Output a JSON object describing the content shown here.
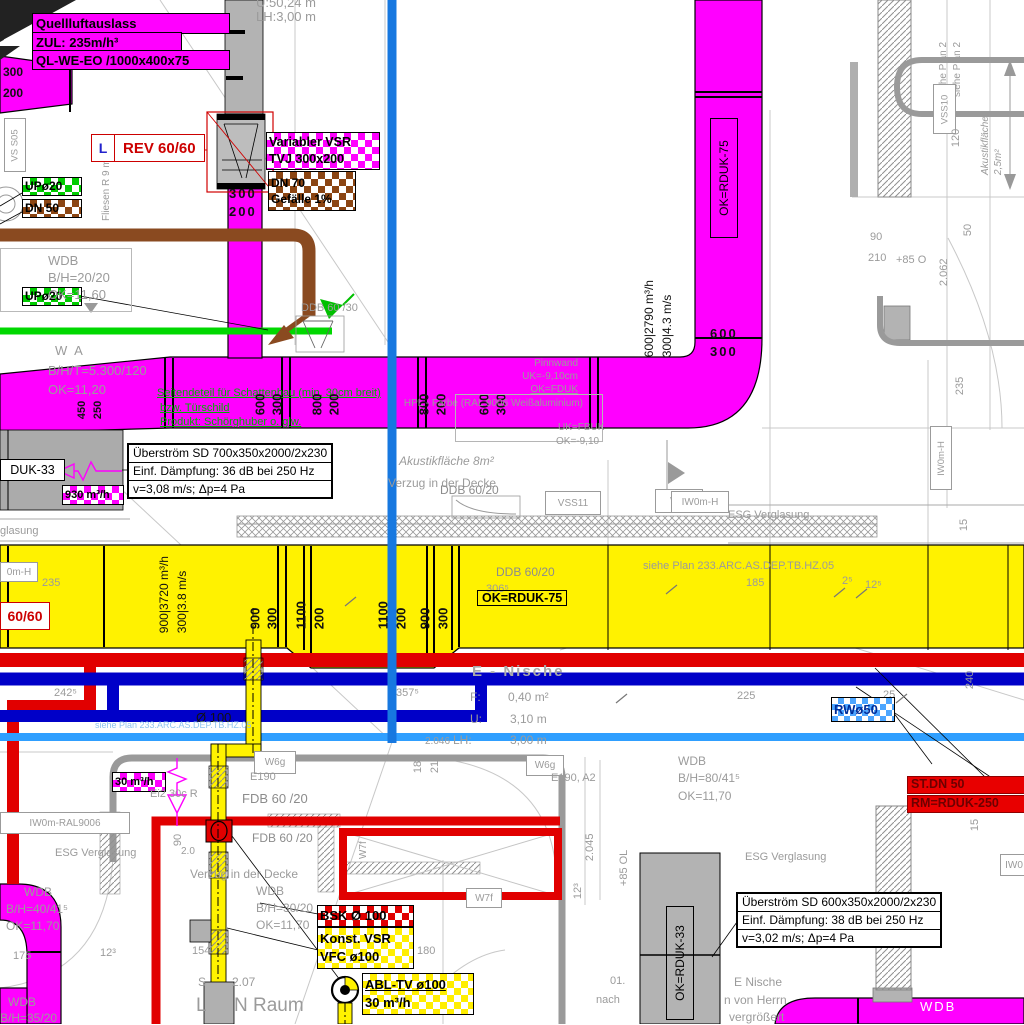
{
  "colors": {
    "duct_supply": "#ff00ff",
    "duct_return": "#fff200",
    "pipe_hot": "#e10000",
    "pipe_cold": "#0000c8",
    "pipe_cw": "#2f9fff",
    "pipe_green": "#00d800",
    "pipe_brown": "#8a4a20",
    "section_line": "#1778e0"
  },
  "dims": {
    "d600": "600",
    "d300": "300",
    "d800": "800",
    "d200": "200",
    "d900": "900",
    "d1100": "1100",
    "flow2790": "600|2790 m³/h",
    "speed43": "300|4.3 m/s",
    "flow3720": "900|3720 m³/h",
    "speed38": "300|3.8 m/s",
    "d450": "450",
    "d250": "250",
    "d235": "235",
    "d185": "185",
    "d2_5": "2⁵",
    "d12_5": "12⁵",
    "d12_3": "12³",
    "d242": "242⁵",
    "d357": "357⁵",
    "d306": "306⁵",
    "d225": "225",
    "d25": "25",
    "d240": "240",
    "d2046": "2.046",
    "d2045": "2.045",
    "d2062": "2.062",
    "d180": "180",
    "d210": "210",
    "d120": "120",
    "d90": "90",
    "d50": "50",
    "d15": "15",
    "d175": "175",
    "d154": "154",
    "plus85o": "+85 O",
    "plus85ol": "+85 OL",
    "d2_0": "2.0"
  },
  "top_left": {
    "outlet1": "Quellluftauslass",
    "outlet2": "ZUL: 235m/h³",
    "outlet3": "QL-WE-EO /1000x400x75",
    "vs_s05": "VS S05",
    "fliesen": "Fliesen R 9 m²",
    "up20": "UPø20",
    "dn50": "DN 50",
    "rev_l": "L",
    "rev": "REV 60/60",
    "vsr1": "Variabler VSR",
    "vsr2": "TVJ 300x200",
    "dn70": "DN 70",
    "gefaelle": "Gefälle 1%",
    "u_dim": "U:50,24 m",
    "lh_dim": "LH:3,00 m",
    "ddb30": "DDB 60 /30"
  },
  "stamps": {
    "wdb": "WDB",
    "bh2020": "B/H=20/20",
    "ok1160": "OK=11,60",
    "wa": "W A",
    "bht": "B/H/T=5.300/120",
    "ok1120": "OK=11,20",
    "bh8041": "B/H=80/41⁵",
    "ok1170": "OK=11,70",
    "bh4041": "B/H=40/41⁵",
    "bh3020": "B/H=30/20",
    "bh3520": "B/H=35/20"
  },
  "door_note": {
    "l1": "Seitendeteil für Schattenbau (min. 30cm breit)",
    "l2": "bzw. Türschild",
    "l3": "Produkt: Schörghuber o. glw."
  },
  "pinnwand": {
    "l1": "Pinnwand",
    "l2": "UK=-9,10cm",
    "l3": "OK=FDUK",
    "l4": "HPL - Farbe (RAL 9006 Weißaluminium)",
    "l5": "UK=FBUK",
    "l6": "OK=-9,10"
  },
  "ueberstrom1": {
    "l1": "Überström SD 700x350x2000/2x230",
    "l2": "Einf. Dämpfung: 36 dB bei 250 Hz",
    "l3": "v=3,08 m/s; Δp=4 Pa"
  },
  "ueberstrom2": {
    "l1": "Überström SD 600x350x2000/2x230",
    "l2": "Einf. Dämpfung: 38 dB bei 250 Hz",
    "l3": "v=3,02 m/s; Δp=4 Pa"
  },
  "tags": {
    "duk33": "DUK-33",
    "flow930": "930 m³/h",
    "flow30": "30 m³/h",
    "rduk75": "OK=RDUK-75",
    "rduk33": "OK=RDUK-33",
    "rw50": "RWø50",
    "bsk": "BSK Ø 100",
    "konst1": "Konst. VSR",
    "konst2": "VFC ø100",
    "abl1": "ABL-TV ø100",
    "stdn": "ST.DN 50",
    "rm250": "RM=RDUK-250",
    "rev6060": "60/60",
    "ddb6020": "DDB 60/20",
    "fdb6020": "FDB 60 /20",
    "ei2": "Ei2 30c R"
  },
  "boxes": {
    "w6g": "W6g",
    "w6f": "W6f",
    "w7f": "W7f",
    "vss10": "VSS10",
    "vss11": "VSS11",
    "iw0mh": "IW0m-H",
    "iw0mh_cut": "0m-H",
    "iw0": "IW0",
    "ral": "IW0m-RAL9006"
  },
  "misc": {
    "esg": "ESG Verglasung",
    "verglasung_cut": "glasung",
    "akustik8": "Akustikfläche 8m²",
    "akustik25a": "Akustikfläche",
    "akustik25b": "2,5m²",
    "verzug": "Verzug in der Decke",
    "siehe233": "siehe Plan 233.ARC.AS.DEP.TB.HZ.05",
    "siehe2": "siehe Plan 2",
    "e_nische": "E - Nische",
    "f_l": "F:",
    "f_v": "0,40 m²",
    "u_l": "U:",
    "u_v": "3,10 m",
    "lh_l": "LH:",
    "lh_v": "3,00 m",
    "dia100": "Ø 100",
    "e190": "E190",
    "e190a2": "E190, A2",
    "o1": "01.",
    "nach": "nach",
    "en1": "E Nische",
    "en2": "n von Herrn",
    "en3": "vergrößert",
    "wdb_w": "WDB",
    "s_a": "S",
    "s_b": "2.07",
    "raum_a": "L",
    "raum_b": "N Raum"
  }
}
